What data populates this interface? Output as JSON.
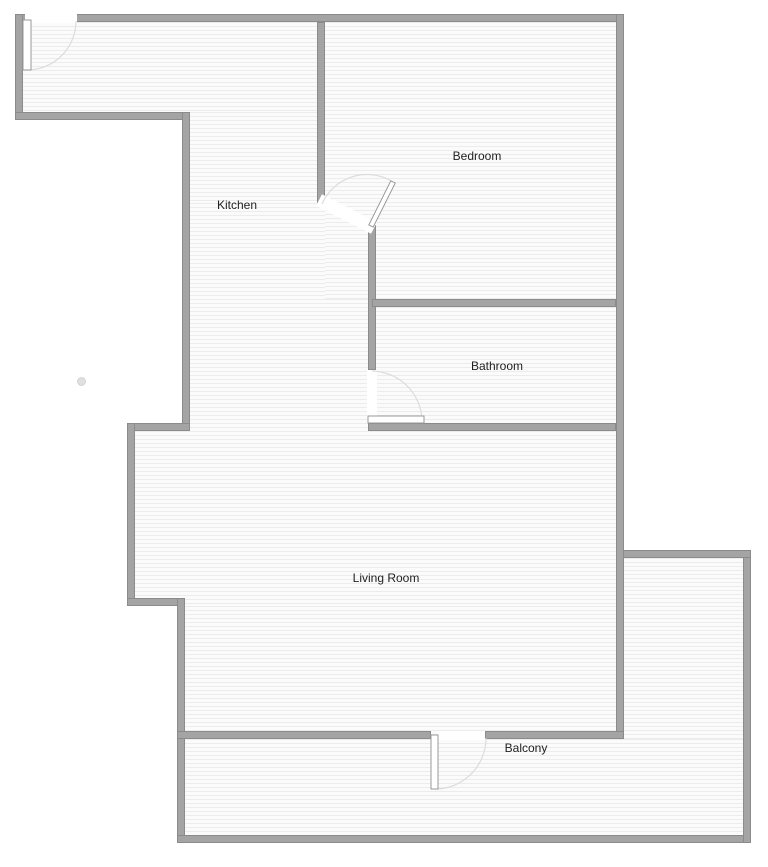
{
  "title": "Apartment floor plan",
  "rooms": [
    {
      "id": "kitchen",
      "label": "Kitchen"
    },
    {
      "id": "bedroom",
      "label": "Bedroom"
    },
    {
      "id": "bathroom",
      "label": "Bathroom"
    },
    {
      "id": "living-room",
      "label": "Living Room"
    },
    {
      "id": "balcony",
      "label": "Balcony"
    }
  ],
  "doors": [
    {
      "id": "entry-door",
      "location": "top wall, upper-left"
    },
    {
      "id": "bedroom-door",
      "location": "between kitchen and bedroom"
    },
    {
      "id": "bathroom-door",
      "location": "between kitchen and bathroom"
    },
    {
      "id": "balcony-door",
      "location": "between living room and balcony"
    }
  ],
  "colors": {
    "wall_fill": "#a4a4a4",
    "wall_edge": "#8b8b8b",
    "floor_bg": "#fbfbfb",
    "floor_hatch": "#ececec",
    "label_text": "#1f1f1f",
    "door_arc": "#dcdcdc",
    "door_jamb": "#9a9a9a"
  }
}
